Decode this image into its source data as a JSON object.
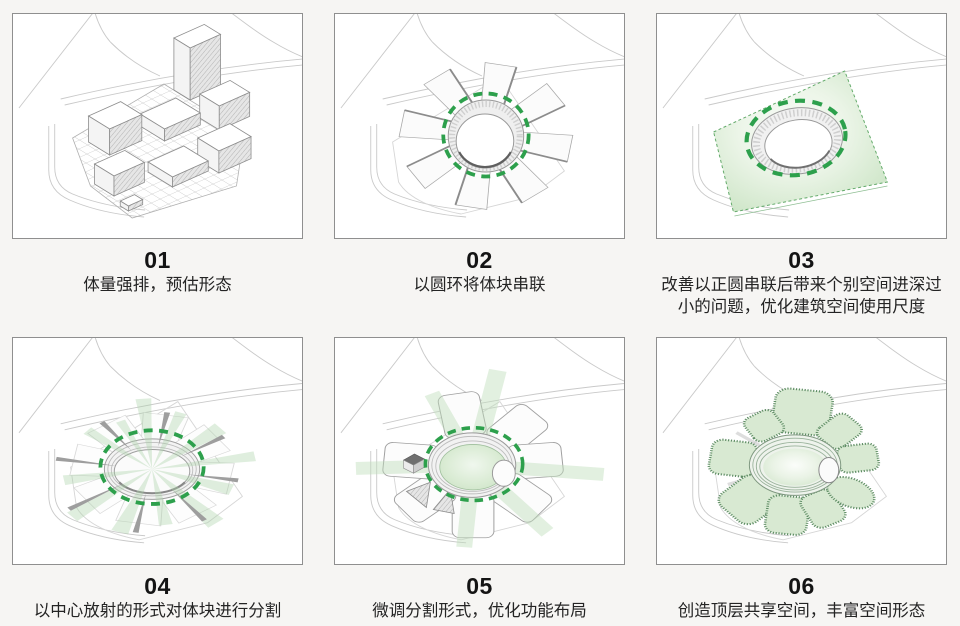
{
  "page": {
    "background": "#f6f5f3",
    "panel_border": "#8f8f8f"
  },
  "colors": {
    "accent_green": "#2da04c",
    "site_green_light": "#d5e8d0",
    "petal_green": "#d8e9d2",
    "petal_border_green": "#5d8c63",
    "sketch_line_gray": "#c9c9c9",
    "text_dark": "#141414"
  },
  "steps": [
    {
      "number": "01",
      "caption": "体量强排，预估形态"
    },
    {
      "number": "02",
      "caption": "以圆环将体块串联"
    },
    {
      "number": "03",
      "caption": "改善以正圆串联后带来个别空间进深过小的问题，优化建筑空间使用尺度"
    },
    {
      "number": "04",
      "caption": "以中心放射的形式对体块进行分割"
    },
    {
      "number": "05",
      "caption": "微调分割形式，优化功能布局"
    },
    {
      "number": "06",
      "caption": "创造顶层共享空间，丰富空间形态"
    }
  ]
}
